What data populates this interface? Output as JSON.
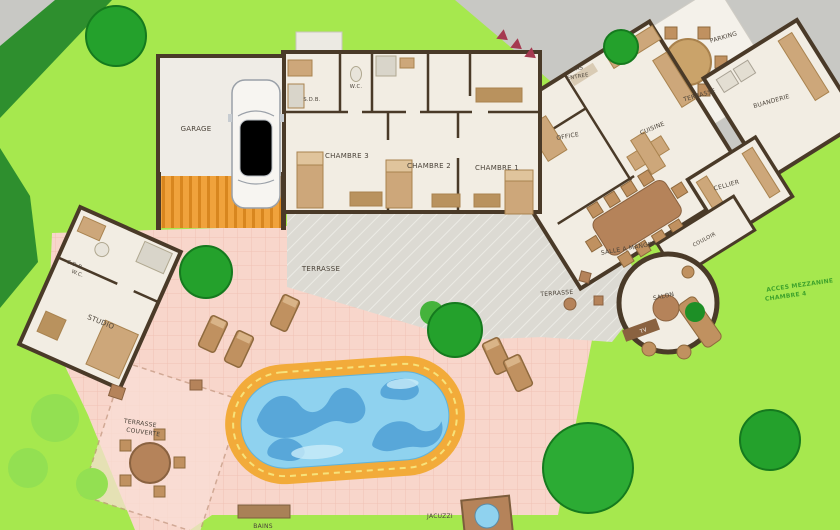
{
  "palette": {
    "lawn": "#a6e84e",
    "hedge": "#2e8f2e",
    "tree": "#24a12c",
    "driveway": "#c8c8c4",
    "house": "#f2ede3",
    "wall": "#4a3a28",
    "patio_pink": "#f8d6cb",
    "terrace_gray": "#dcdad3",
    "apron_orange": "#f0a23c",
    "pool_deck": "#f2ab3a",
    "water": "#8fd2ef",
    "wave": "#4fa0d6",
    "wood": "#b5835a",
    "accent_red": "#a53a50",
    "label": "#4a4238",
    "label_green": "#3fa32c"
  },
  "labels": {
    "garage": "GARAGE",
    "sdb": "S.D.B.",
    "wc": "W.C.",
    "chambre3": "CHAMBRE 3",
    "chambre2": "CHAMBRE 2",
    "chambre1": "CHAMBRE 1",
    "sas_line1": "SAS",
    "sas_line2": "ENTREE",
    "office": "OFFICE",
    "cuisine": "CUISINE",
    "terrasse_nord": "TERRASSE",
    "parking": "PARKING",
    "buanderie": "BUANDERIE",
    "cellier": "CELLIER",
    "salle_a_manger": "SALLE A MANGER",
    "couloir": "COULOIR",
    "terrasse_salon": "TERRASSE",
    "salon": "SALON",
    "tv": "TV",
    "acces_line1": "ACCES MEZZANINE",
    "acces_line2": "CHAMBRE 4",
    "terrasse_sud": "TERRASSE",
    "studio_sdb_line1": "S.D.B",
    "studio_sdb_line2": "W.C.",
    "studio": "STUDIO",
    "terrasse_couverte_line1": "TERRASSE",
    "terrasse_couverte_line2": "COUVERTE",
    "bains": "BAINS",
    "jacuzzi": "JACUZZI"
  }
}
